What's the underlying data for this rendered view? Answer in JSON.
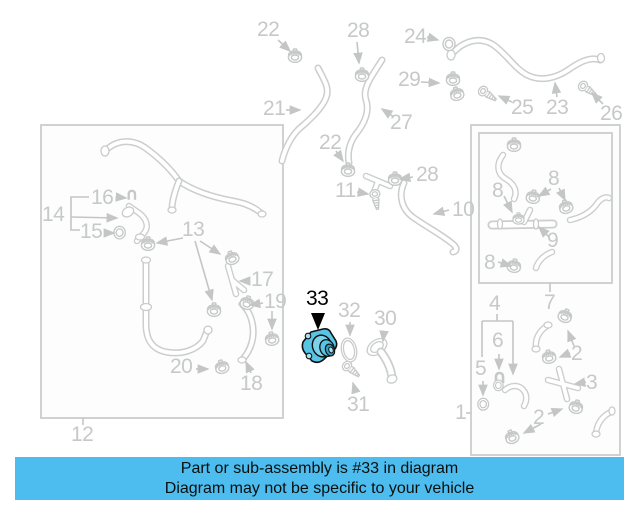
{
  "diagram": {
    "highlighted_part_number": "33",
    "highlight_color": "#58c5e5",
    "line_color": "#cbcecd",
    "callouts": [
      {
        "id": "22-top",
        "text": "22"
      },
      {
        "id": "28-top",
        "text": "28"
      },
      {
        "id": "24",
        "text": "24"
      },
      {
        "id": "29",
        "text": "29"
      },
      {
        "id": "21",
        "text": "21"
      },
      {
        "id": "25",
        "text": "25"
      },
      {
        "id": "23",
        "text": "23"
      },
      {
        "id": "26",
        "text": "26"
      },
      {
        "id": "27",
        "text": "27"
      },
      {
        "id": "22-mid",
        "text": "22"
      },
      {
        "id": "28-mid",
        "text": "28"
      },
      {
        "id": "11",
        "text": "11"
      },
      {
        "id": "10",
        "text": "10"
      },
      {
        "id": "16",
        "text": "16"
      },
      {
        "id": "14",
        "text": "14"
      },
      {
        "id": "15",
        "text": "15"
      },
      {
        "id": "13",
        "text": "13"
      },
      {
        "id": "17",
        "text": "17"
      },
      {
        "id": "19",
        "text": "19"
      },
      {
        "id": "20",
        "text": "20"
      },
      {
        "id": "18",
        "text": "18"
      },
      {
        "id": "12",
        "text": "12"
      },
      {
        "id": "33",
        "text": "33"
      },
      {
        "id": "32",
        "text": "32"
      },
      {
        "id": "30",
        "text": "30"
      },
      {
        "id": "31",
        "text": "31"
      },
      {
        "id": "8-a",
        "text": "8"
      },
      {
        "id": "8-b",
        "text": "8"
      },
      {
        "id": "9",
        "text": "9"
      },
      {
        "id": "8-c",
        "text": "8"
      },
      {
        "id": "4",
        "text": "4"
      },
      {
        "id": "7",
        "text": "7"
      },
      {
        "id": "6",
        "text": "6"
      },
      {
        "id": "5",
        "text": "5"
      },
      {
        "id": "2-a",
        "text": "2"
      },
      {
        "id": "3",
        "text": "3"
      },
      {
        "id": "2-b",
        "text": "2"
      },
      {
        "id": "1",
        "text": "1"
      }
    ]
  },
  "banner": {
    "background_color": "#4dbcee",
    "line1": "Part or sub-assembly is #33 in diagram",
    "line2": "Diagram may not be specific to your vehicle"
  }
}
